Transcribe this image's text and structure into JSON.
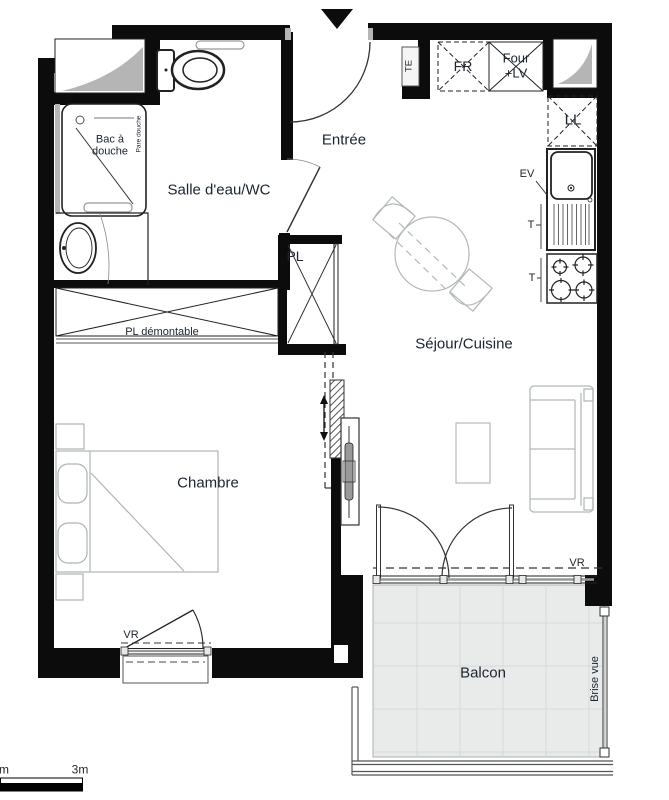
{
  "rooms": {
    "entree": "Entrée",
    "salle_eau": "Salle d'eau/WC",
    "sejour": "Séjour/Cuisine",
    "chambre": "Chambre",
    "balcon": "Balcon"
  },
  "fixtures": {
    "bac_line1": "Bac à",
    "bac_line2": "douche",
    "pare_douche": "Pare douche",
    "pl": "PL",
    "pl_demontable": "PL démontable",
    "fr": "FR",
    "four": "Four",
    "four_lv": "+LV",
    "ll": "LL",
    "ev": "EV",
    "t": "T",
    "te": "TE",
    "vr": "VR",
    "brise_vue": "Brise vue"
  },
  "scale_bar": {
    "left_label": "m",
    "right_label": "3m"
  },
  "colors": {
    "wall": "#0c0c0c",
    "furniture_line": "#b3b9b9",
    "shaft_fill": "#b5b5b5",
    "balcony_tile": "#e9ebea",
    "balcony_grout": "#d4d8d7",
    "text": "#1b2430"
  }
}
